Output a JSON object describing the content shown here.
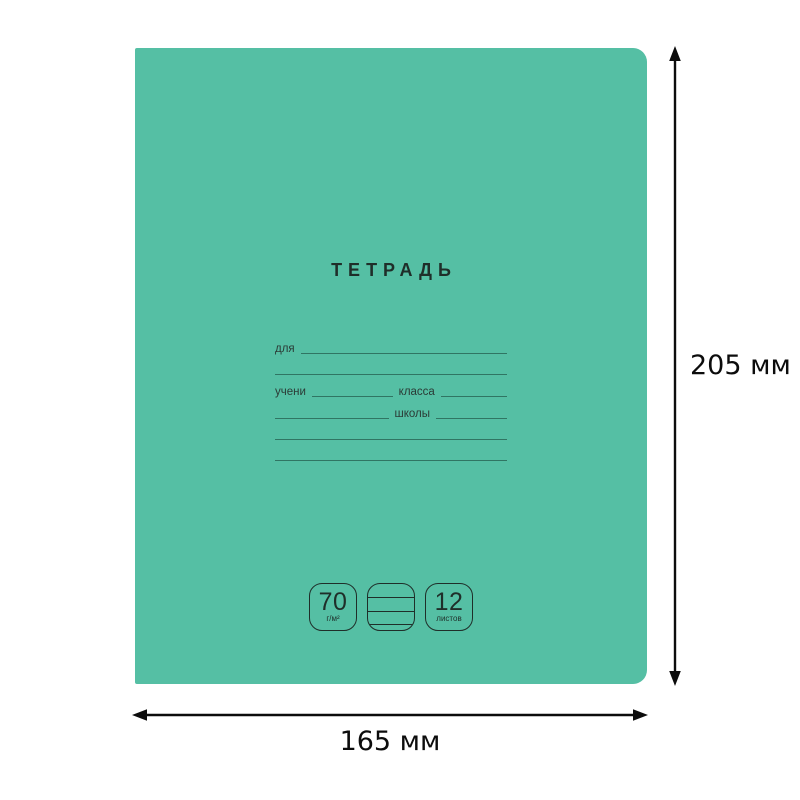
{
  "notebook_cover": {
    "cover_color": "#55bfa4",
    "title": "ТЕТРАДЬ",
    "owner_line_label": "для",
    "student_label": "учени",
    "class_label": "класса",
    "school_label": "школы",
    "paper_weight": {
      "value": "70",
      "unit": "г/м²"
    },
    "sheet_count": {
      "value": "12",
      "unit": "листов"
    },
    "icons": {
      "middle_badge": "lined-pages-icon"
    }
  },
  "dimension_annotations": {
    "height": "205 мм",
    "width": "165 мм"
  }
}
